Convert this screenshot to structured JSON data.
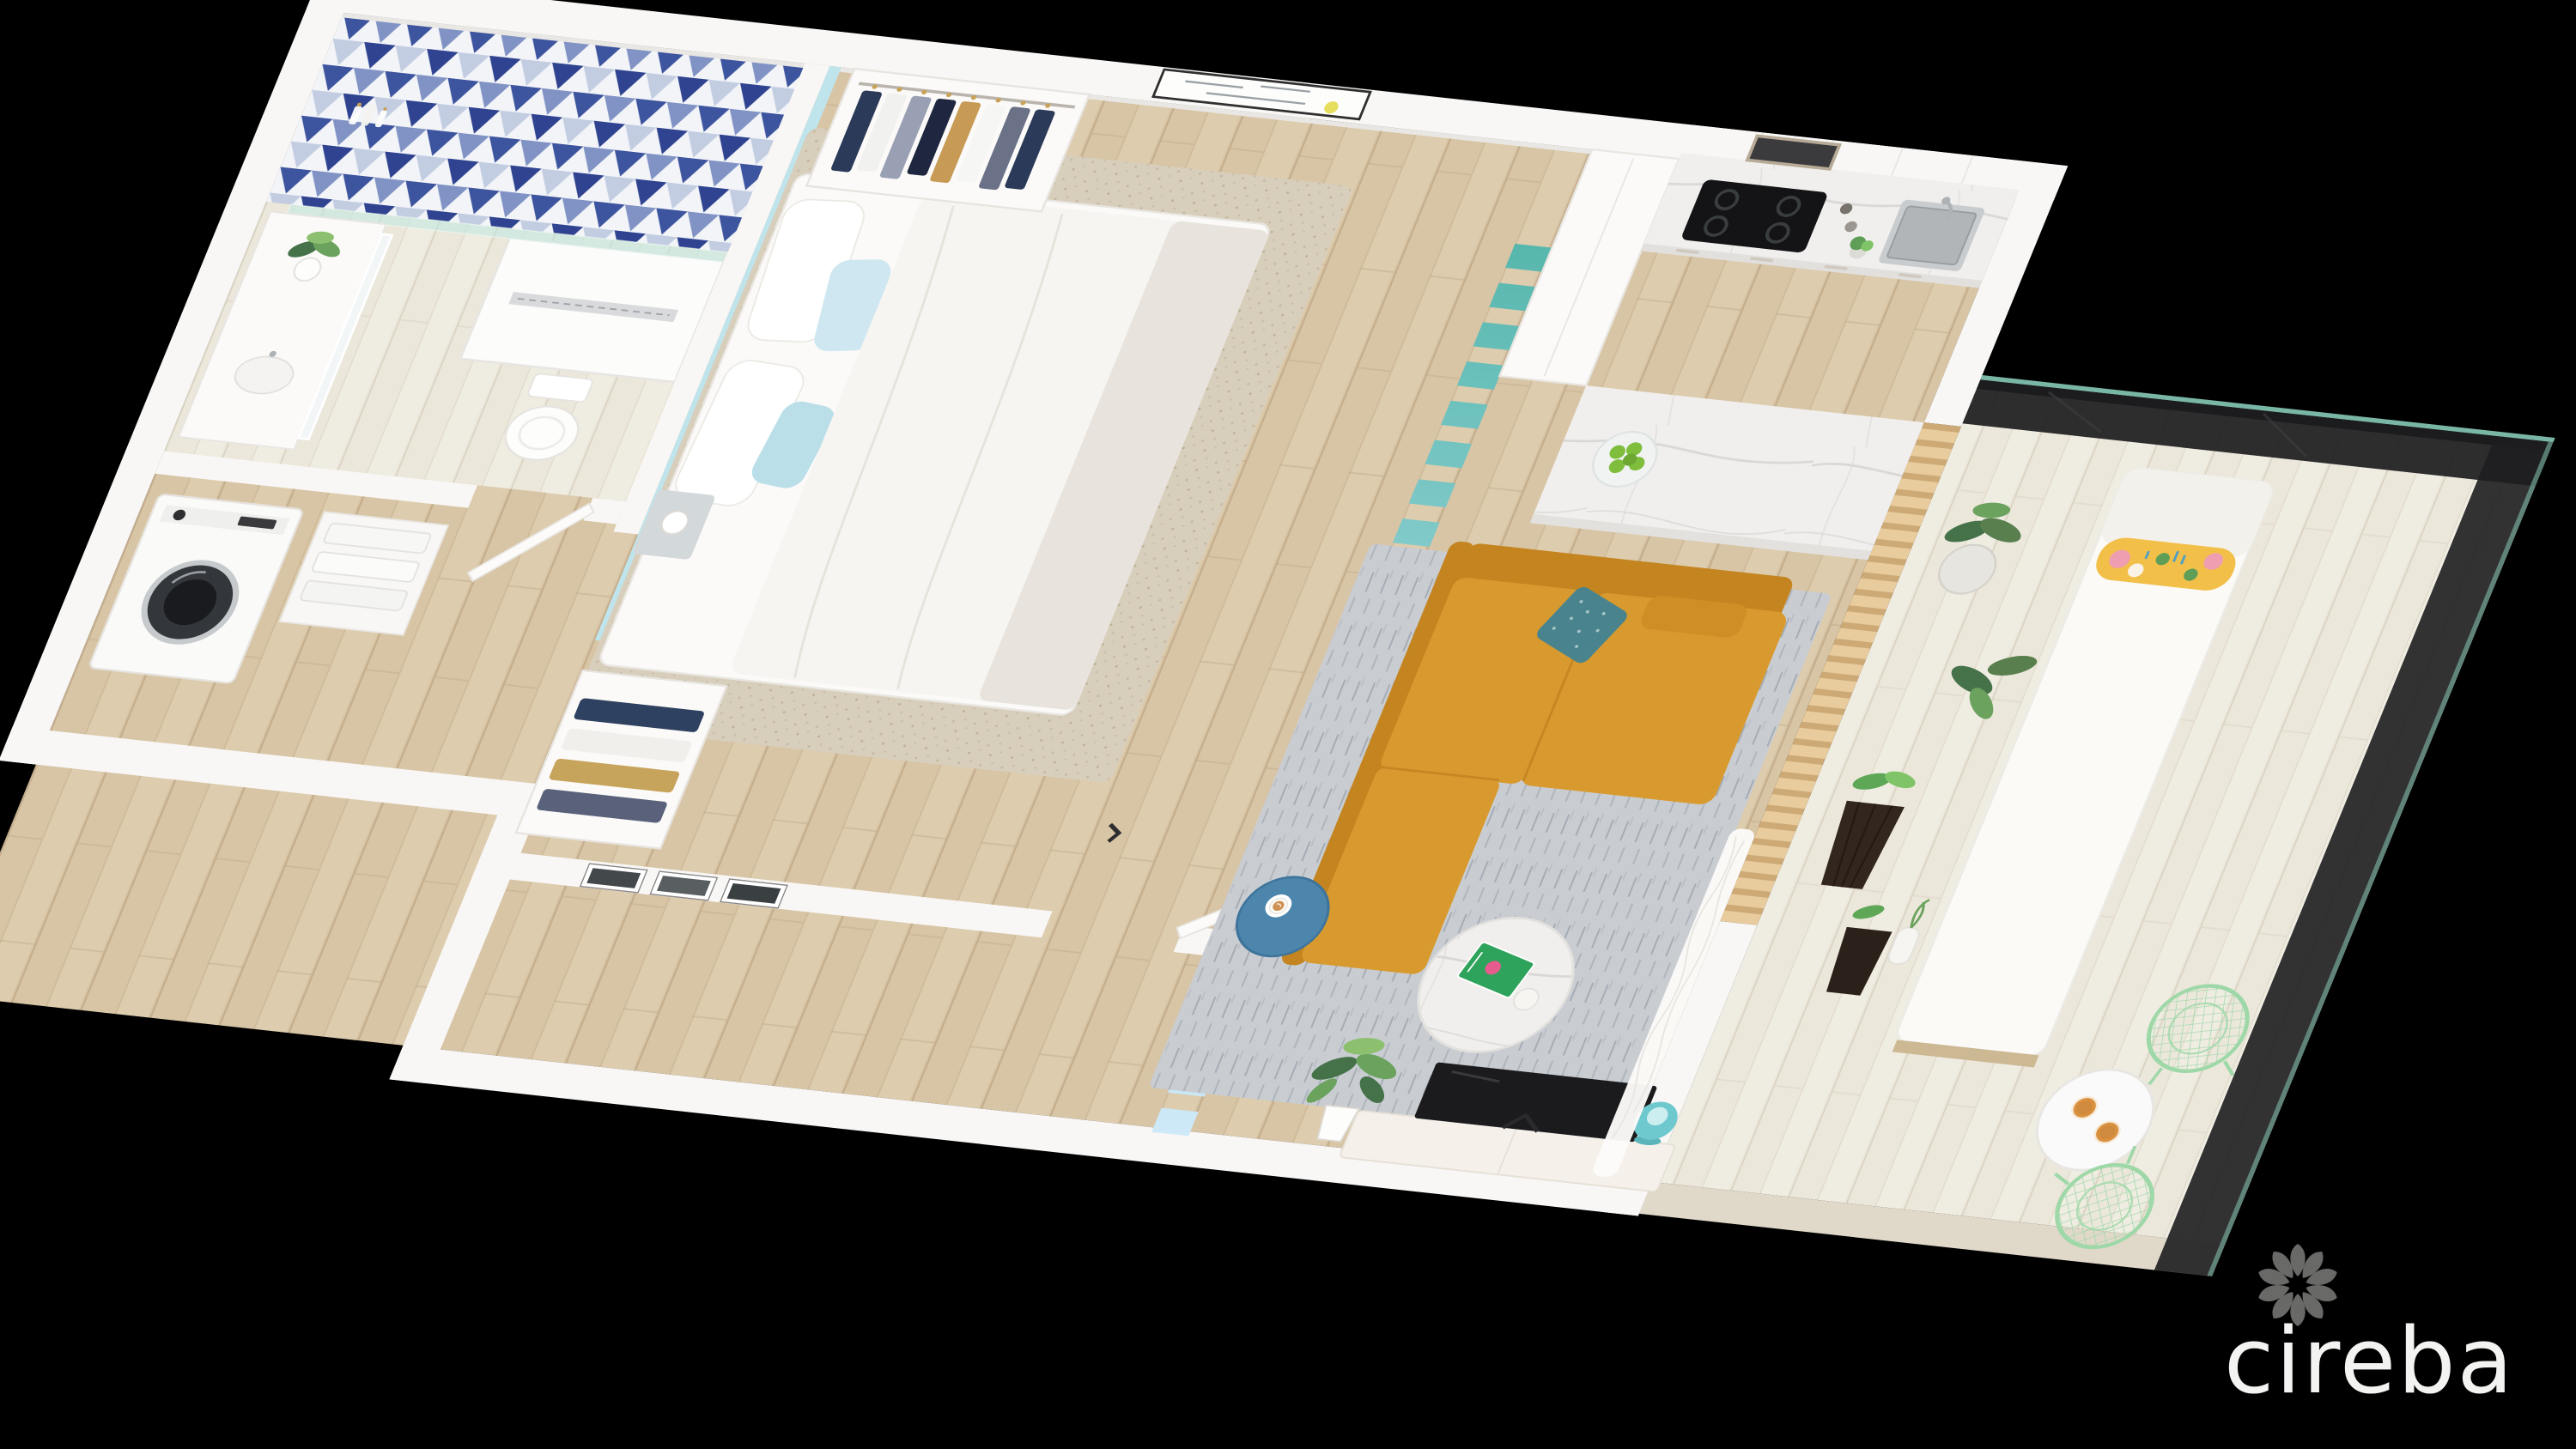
{
  "watermark": {
    "brand": "cireba",
    "icon": "flower-petal-logo"
  },
  "scene": {
    "type": "3d-floor-plan-render",
    "style": "isometric cutaway of a studio apartment on black background",
    "rooms": [
      {
        "name": "bathroom",
        "features": [
          "blue triangle mosaic tiled shower wall",
          "walk-in shower with linear drain",
          "glass shower screen",
          "toilet",
          "vanity with backlit mirror",
          "potted plant",
          "shampoo bottles"
        ]
      },
      {
        "name": "entry-laundry",
        "features": [
          "front-loading washing machine",
          "towel shelves",
          "open white door"
        ]
      },
      {
        "name": "bedroom",
        "features": [
          "double bed with white duvet",
          "pale-blue accent headboard wall",
          "white and light-blue pillows",
          "open wardrobe with hanging clothes",
          "second open closet",
          "floating shelf with sphere lamp",
          "abstract wall art with yellow accent",
          "triptych of black-and-white photos",
          "open white door",
          "beige woven rug"
        ]
      },
      {
        "name": "kitchen",
        "features": [
          "white flat-front cabinets",
          "marble backsplash and countertop",
          "built-in stainless microwave",
          "black four-burner cooktop",
          "stainless undermount sink",
          "marble island",
          "bowl of green apples",
          "herb pot",
          "salt and pepper grinders"
        ]
      },
      {
        "name": "living-room",
        "features": [
          "mustard L-shaped sofa",
          "teal patterned cushion",
          "blue round side table with latte",
          "round marble coffee table",
          "green TULUM book",
          "gray woven rug",
          "black flat-screen TV on white media console",
          "turquoise table lamp",
          "potted plant",
          "sheer white curtain",
          "teal-to-blue gradient fin room divider",
          "wood slat screen"
        ]
      },
      {
        "name": "balcony",
        "features": [
          "whitewashed wood deck",
          "dark glass railing",
          "white chaise daybed",
          "tropical print bolster pillow",
          "plants in white pot",
          "dark faceted planters",
          "white bud vase",
          "round white bistro table",
          "two amber drinks",
          "two mint wire chairs"
        ]
      }
    ]
  },
  "palette": {
    "bg": "#000000",
    "wall": "#f8f7f5",
    "wall-edge": "#e9e7e3",
    "wood": "#d8c5a6",
    "wood-seam": "#c2ab89",
    "deck": "#ece7db",
    "deck-seam": "#d9d2c2",
    "tile-navy": "#3d549e",
    "tile-mid": "#8093c4",
    "tile-pale": "#c3cde2",
    "tile-bg": "#f2f4f8",
    "accent-wall": "#bfe4ec",
    "fin-teal": "#57b7ad",
    "fin-blue": "#cfe9f8",
    "marble": "#f0efed",
    "marble-vein": "#d8d6d3",
    "sofa": "#d89a2e",
    "sofa-dark": "#c48521",
    "pillow-teal": "#49848e",
    "side-table": "#4d86ad",
    "rug": "#c9cdd2",
    "rug-streak": "#9aa1ab",
    "rug-bed": "#d8cebc",
    "tv": "#1b1b1d",
    "lamp": "#6ec9cf",
    "mint": "#9ed8a8",
    "amber": "#d9913f",
    "apple": "#7fbe3c",
    "leaf-dark": "#46724a",
    "leaf": "#6aa25e",
    "leaf-light": "#8cc06f",
    "planter": "#33261e",
    "slat": "#e9cc9d",
    "slat-dark": "#c9a571",
    "glass": "#1e1e20",
    "glass-edge": "#8fd6c2",
    "steel": "#b9bcbe",
    "logo": "#fbfbf9"
  }
}
